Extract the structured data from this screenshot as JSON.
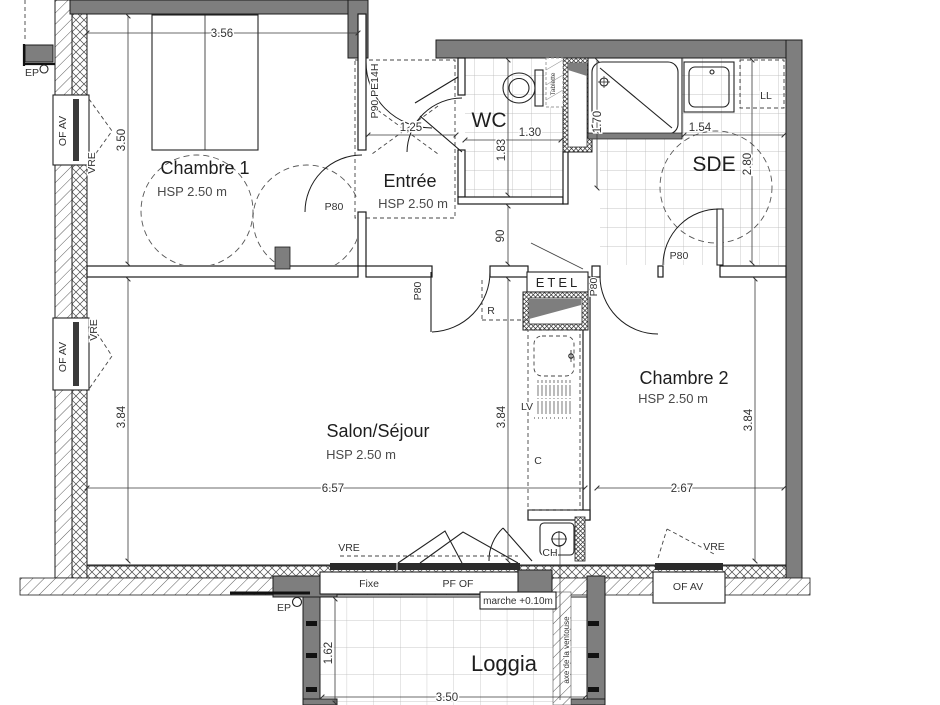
{
  "rooms": {
    "chambre1": {
      "name": "Chambre 1",
      "hsp": "HSP 2.50 m"
    },
    "entree": {
      "name": "Entrée",
      "hsp": "HSP 2.50 m"
    },
    "wc": {
      "name": "WC"
    },
    "sde": {
      "name": "SDE"
    },
    "chambre2": {
      "name": "Chambre 2",
      "hsp": "HSP 2.50 m"
    },
    "salon": {
      "name": "Salon/Séjour",
      "hsp": "HSP 2.50 m"
    },
    "loggia": {
      "name": "Loggia"
    }
  },
  "dims": {
    "chambre1_width": "3.56",
    "chambre1_depth": "3.50",
    "entree_width": "1,25",
    "wc_width": "1.30",
    "wc_depth": "1.83",
    "hall_width": "90",
    "shower_length": "1.70",
    "sde_width": "1.54",
    "sde_depth": "2.80",
    "salon_depth": "3.84",
    "kitchen_depth": "3.84",
    "chambre2_depth": "3.84",
    "salon_width": "6.57",
    "chambre2_width": "2.67",
    "loggia_depth": "1.62",
    "loggia_width": "3.50"
  },
  "doors": {
    "entrance": "P90 PE14H",
    "chambre1": "P80",
    "salon": "P80",
    "chambre2": "P80",
    "sde": "P80"
  },
  "windows": {
    "of_av": "OF AV",
    "vre": "VRE",
    "fixe": "Fixe",
    "pf_of": "PF OF"
  },
  "equipment": {
    "ep": "EP",
    "ll": "LL",
    "tablette": "Tablette",
    "etel": "ETEL",
    "fridge": "R",
    "dishwasher": "LV",
    "cooker": "C",
    "boiler": "CH",
    "step": "marche +0.10m",
    "flue": "axe de la ventouse"
  },
  "colors": {
    "wall": "#7e7e7e",
    "line": "#1c1c1c",
    "tile": "#b3b3b3"
  }
}
